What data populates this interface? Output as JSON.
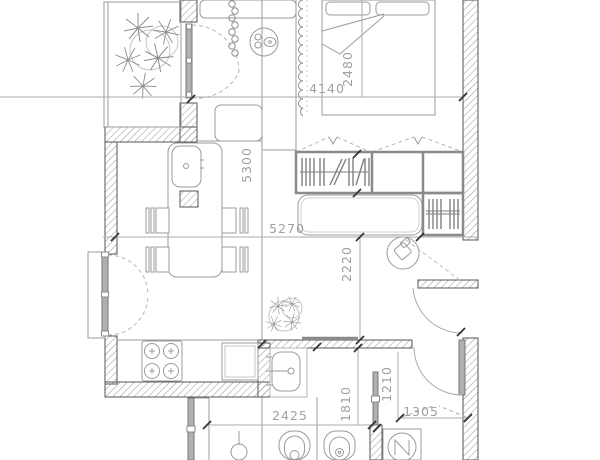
{
  "plan": {
    "type": "apartment-floor-plan",
    "dimension_labels": {
      "bedroom_width_mm": "4140",
      "bed_zone_mm": "2480",
      "living_length_mm": "5300",
      "living_width_mm": "5270",
      "hall_depth_mm": "2220",
      "bathroom_width_mm": "2425",
      "bathroom_depth_mm": "1810",
      "wc_depth_mm": "1210",
      "entry_width_mm": "1305"
    },
    "colors": {
      "background": "#ffffff",
      "wall_outline": "#555555",
      "hatch_line": "#8a8a8a",
      "furniture_line": "#9b9b9b",
      "dimension_line": "#ababab",
      "dimension_text": "#a0a0a0",
      "door_leaf_fill": "#b0b0b0",
      "tick_mark": "#333333"
    },
    "fixtures": [
      "double-bed",
      "bed-pillows",
      "duvet-fold",
      "window-curtain",
      "bead-curtain",
      "round-side-table",
      "hallway-cabinet",
      "balcony-plant",
      "wardrobe-hangers",
      "bench-sofa",
      "shoe-rack-hangers",
      "armchair",
      "kitchen-island",
      "island-sink",
      "island-column",
      "dining-chairs",
      "balcony-french-door",
      "glazed-interior-door",
      "cooktop-4-burners",
      "oven",
      "washbasin",
      "bathroom-plant",
      "toilet",
      "bidet",
      "washing-machine",
      "floor-pedestal",
      "entrance-door",
      "hall-door"
    ]
  }
}
